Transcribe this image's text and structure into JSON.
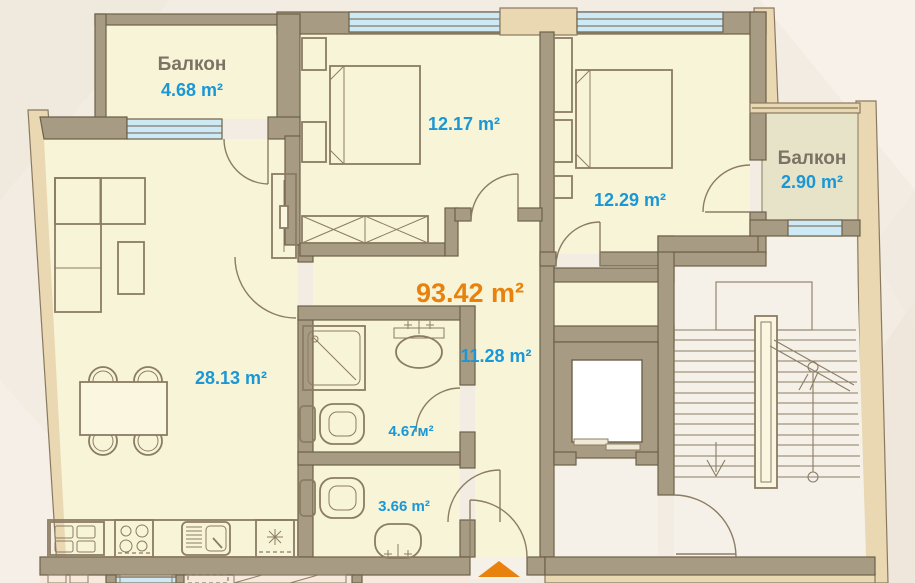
{
  "plan_type": "apartment-floor-plan",
  "total_area": "93.42 m²",
  "rooms": {
    "balcony_left": {
      "name": "Балкон",
      "area": "4.68 m²"
    },
    "bedroom_1": {
      "area": "12.17 m²"
    },
    "bedroom_2": {
      "area": "12.29 m²"
    },
    "balcony_right": {
      "name": "Балкон",
      "area": "2.90 m²"
    },
    "living_room_kitchen": {
      "area": "28.13 m²"
    },
    "hallway": {
      "area": "11.28 m²"
    },
    "bathroom": {
      "area": "4.67м²"
    },
    "wc": {
      "area": "3.66 m²"
    }
  },
  "icons": {
    "entrance_arrow": "orange triangle pointing up at apartment entry",
    "stairs_down_arrow": "arrow down on staircase",
    "section_line": "diagonal stair break line with circles"
  },
  "colors": {
    "area_label": "#1a97d5",
    "total_label": "#e8820c",
    "room_name_label": "#7c7365",
    "wall": "#a89b84",
    "outer_wall": "#ead8b2",
    "floor": "#f8f4d7",
    "balcony_floor": "#e6e3c8",
    "common_floor": "#f5f1e8",
    "window": "#cde9f5",
    "entrance_arrow": "#e8820c",
    "background": "#f2ece3"
  }
}
